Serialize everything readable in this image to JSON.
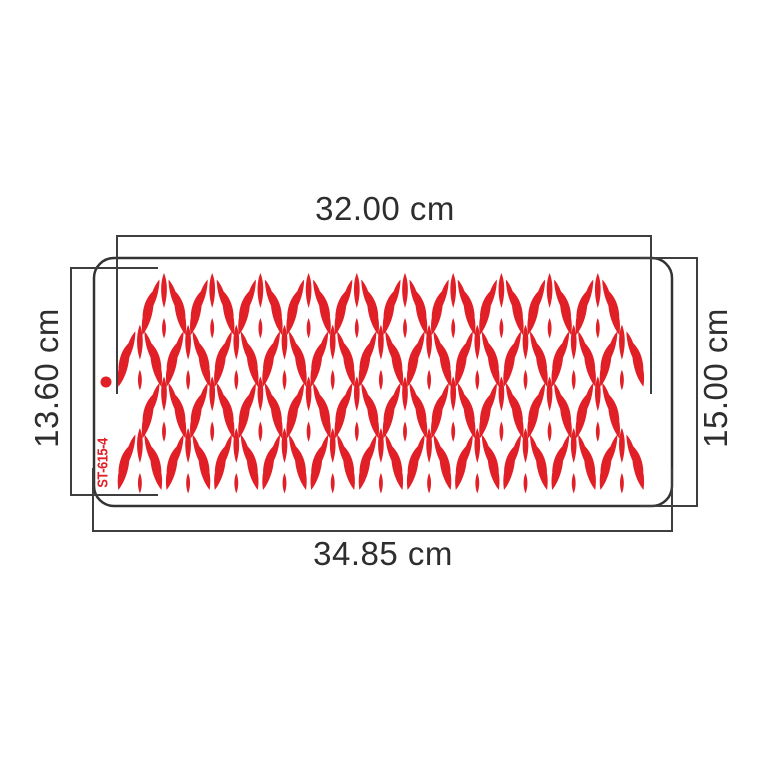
{
  "figure": {
    "description": "stencil-product-dimension-diagram",
    "product_code": "ST-615-4",
    "dimensions": {
      "top_width": "32.00 cm",
      "bottom_width": "34.85 cm",
      "left_height": "13.60 cm",
      "right_height": "15.00 cm"
    },
    "colors": {
      "pattern_red": "#e11f26",
      "line_gray": "#3e3e3e",
      "stencil_stroke": "#333333",
      "text_dark": "#2e2e2e",
      "background": "#ffffff"
    },
    "stencil": {
      "x": 94,
      "y": 258,
      "width": 578,
      "height": 248,
      "corner_radius": 20
    },
    "registration_dot": {
      "x": 106,
      "y": 382,
      "r": 5.5
    },
    "pattern": {
      "motif": "leaf-palmette",
      "pitch_x": 48.2,
      "rows": [
        {
          "count": 10,
          "x0": 164,
          "y0": 273
        },
        {
          "count": 11,
          "x0": 139.9,
          "y0": 324.8
        },
        {
          "count": 10,
          "x0": 164,
          "y0": 376.4
        },
        {
          "count": 11,
          "x0": 139.9,
          "y0": 428
        }
      ]
    }
  }
}
